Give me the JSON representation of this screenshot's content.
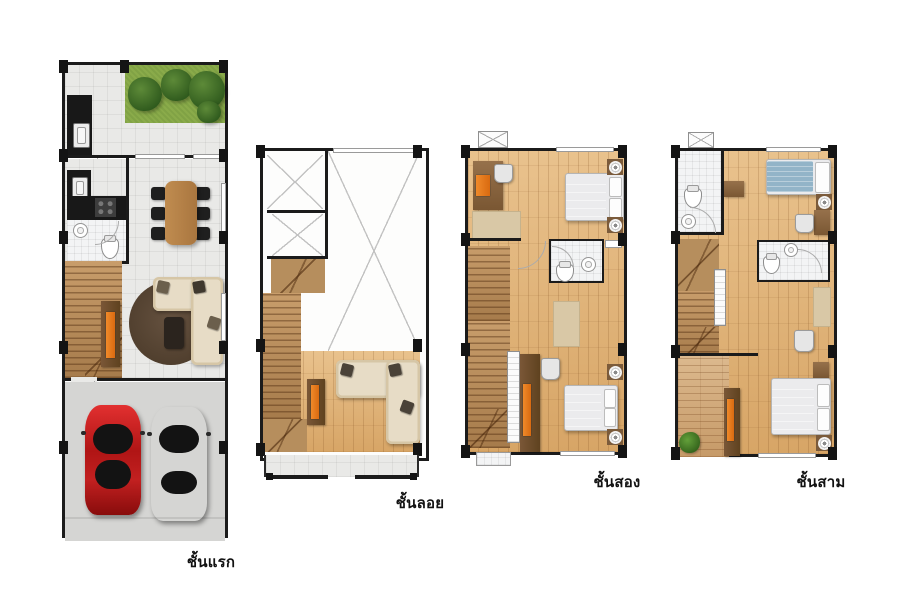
{
  "document": {
    "type": "townhouse-floor-plans",
    "background": "#ffffff"
  },
  "floor_plans": [
    {
      "id": "first-floor",
      "label": "ชั้นแรก",
      "features": [
        "garden",
        "patio",
        "kitchen-counter",
        "dining-table",
        "bathroom",
        "staircase",
        "tv-console",
        "living-sofa",
        "round-rug",
        "garage",
        "red-car",
        "silver-car"
      ]
    },
    {
      "id": "mezzanine",
      "label": "ชั้นลอย",
      "features": [
        "void-open-to-below",
        "staircase",
        "tv-console",
        "corner-sofa",
        "balcony"
      ]
    },
    {
      "id": "second-floor",
      "label": "ชั้นสอง",
      "features": [
        "bedroom-front",
        "desk",
        "bed",
        "bathroom",
        "staircase",
        "wardrobe",
        "tv-console",
        "bedroom-back",
        "air-conditioner"
      ]
    },
    {
      "id": "third-floor",
      "label": "ชั้นสาม",
      "features": [
        "bathroom-front",
        "blue-bed",
        "desk",
        "bathroom-middle",
        "staircase",
        "terrace",
        "plant",
        "tv-console",
        "bedroom-back",
        "air-conditioner"
      ]
    }
  ],
  "colors": {
    "wall": "#1b1b1b",
    "wood_floor": "#e0b47c",
    "tile_floor": "#e9e9e7",
    "bath_tile": "#f3f4f5",
    "stair_wood": "#b68e5d",
    "garage_floor": "#d5d5d3",
    "garden_green": "#8aab4a",
    "tree_green": "#3c6b27",
    "furniture_brown": "#7a5737",
    "tv_orange": "#e2791f",
    "sofa_cream": "#e7dcc6",
    "bed_white": "#ebebed",
    "bed_blue": "#92b4c8",
    "car_red": "#b01515",
    "car_silver": "#cfcfcf",
    "rug_brown": "#4e3d2c",
    "rug_beige": "#d9c8a6"
  }
}
